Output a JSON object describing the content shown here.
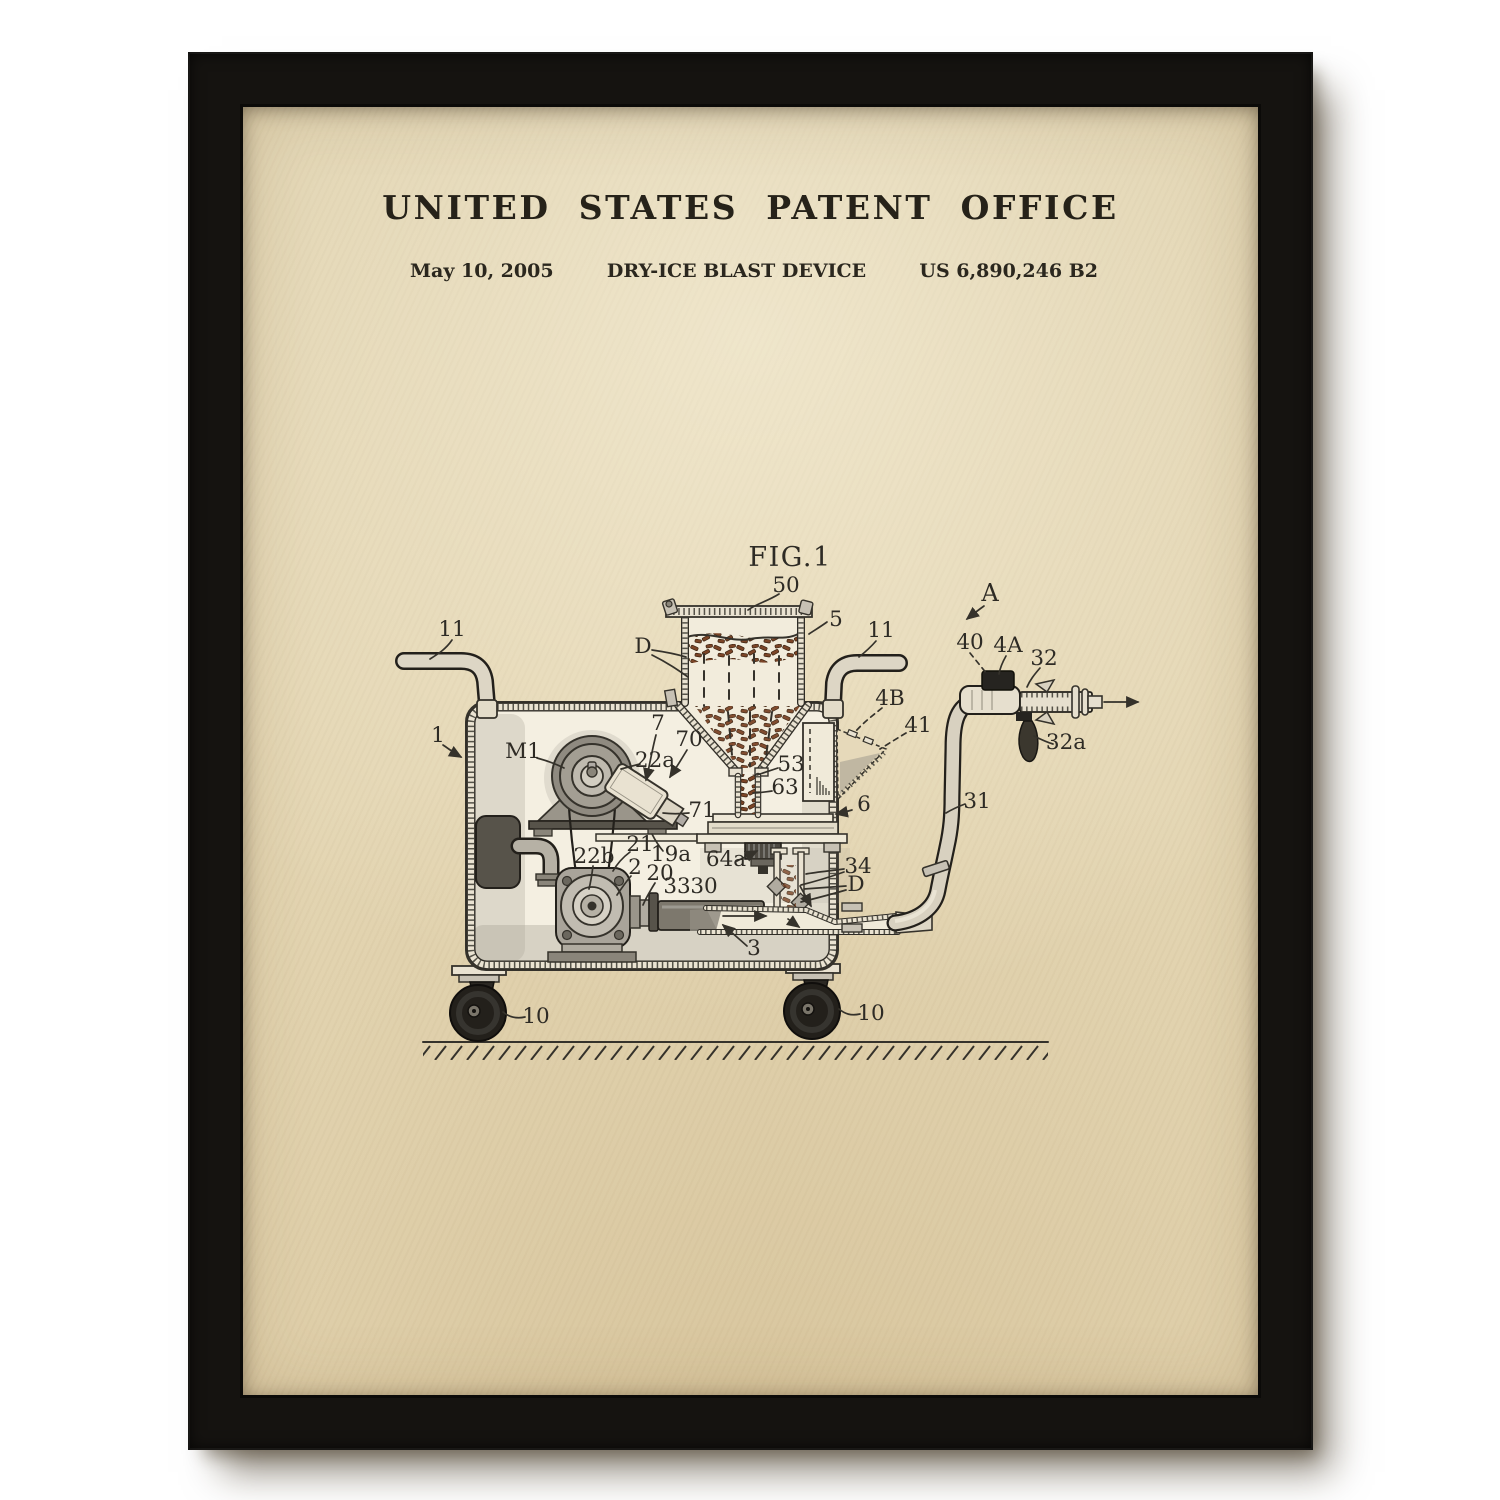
{
  "poster": {
    "header": {
      "title": "UNITED STATES PATENT OFFICE",
      "date": "May 10, 2005",
      "invention_title": "DRY-ICE BLAST DEVICE",
      "patent_number": "US 6,890,246 B2"
    },
    "figure": {
      "caption": "FIG.1",
      "labels": [
        {
          "text": "FIG.1",
          "x": 790,
          "y": 566,
          "size": "lg"
        },
        {
          "text": "50",
          "x": 786,
          "y": 592
        },
        {
          "text": "A",
          "x": 990,
          "y": 601,
          "size": "md"
        },
        {
          "text": "11",
          "x": 452,
          "y": 636
        },
        {
          "text": "D",
          "x": 643,
          "y": 653
        },
        {
          "text": "5",
          "x": 836,
          "y": 626
        },
        {
          "text": "11",
          "x": 881,
          "y": 637
        },
        {
          "text": "40",
          "x": 970,
          "y": 649
        },
        {
          "text": "4A",
          "x": 1008,
          "y": 652
        },
        {
          "text": "32",
          "x": 1044,
          "y": 665
        },
        {
          "text": "4B",
          "x": 890,
          "y": 705
        },
        {
          "text": "41",
          "x": 918,
          "y": 732
        },
        {
          "text": "1",
          "x": 438,
          "y": 742
        },
        {
          "text": "M1",
          "x": 523,
          "y": 758
        },
        {
          "text": "7",
          "x": 658,
          "y": 730
        },
        {
          "text": "70",
          "x": 689,
          "y": 746
        },
        {
          "text": "22a",
          "x": 655,
          "y": 767
        },
        {
          "text": "32a",
          "x": 1066,
          "y": 749
        },
        {
          "text": "53",
          "x": 791,
          "y": 771
        },
        {
          "text": "63",
          "x": 785,
          "y": 794
        },
        {
          "text": "6",
          "x": 864,
          "y": 811
        },
        {
          "text": "71",
          "x": 702,
          "y": 817
        },
        {
          "text": "31",
          "x": 977,
          "y": 808
        },
        {
          "text": "21",
          "x": 640,
          "y": 851
        },
        {
          "text": "22b",
          "x": 594,
          "y": 863
        },
        {
          "text": "19a",
          "x": 671,
          "y": 861
        },
        {
          "text": "2",
          "x": 635,
          "y": 874
        },
        {
          "text": "64a",
          "x": 726,
          "y": 866
        },
        {
          "text": "20",
          "x": 660,
          "y": 880
        },
        {
          "text": "34",
          "x": 858,
          "y": 873
        },
        {
          "text": "33",
          "x": 677,
          "y": 893
        },
        {
          "text": "30",
          "x": 704,
          "y": 893
        },
        {
          "text": "D",
          "x": 856,
          "y": 891
        },
        {
          "text": "3",
          "x": 754,
          "y": 955
        },
        {
          "text": "10",
          "x": 536,
          "y": 1023
        },
        {
          "text": "10",
          "x": 871,
          "y": 1020
        }
      ]
    },
    "colors": {
      "paper": "#e3d4b1",
      "frame": "#141210",
      "ink": "#35322b",
      "pellet_brown": "#7b4426",
      "machine_gray": "#a9a49a",
      "wheel_black": "#211e1a"
    }
  }
}
